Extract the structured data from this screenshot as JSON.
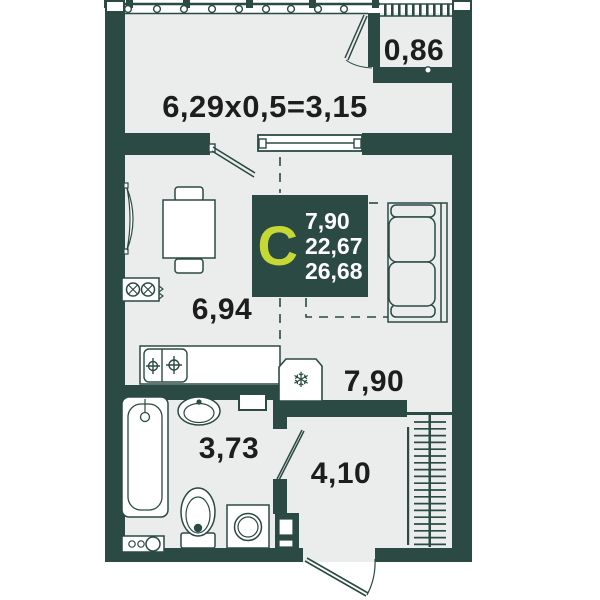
{
  "plan": {
    "labels": {
      "balcony_calc": "6,29х0,5=3,15",
      "balcony_small": "0,86",
      "kitchen_living": "6,94",
      "room": "7,90",
      "bathroom": "3,73",
      "hallway": "4,10"
    },
    "badge": {
      "type_letter": "С",
      "room_area": "7,90",
      "living_area": "22,67",
      "total_area": "26,68"
    },
    "icons": {
      "fridge_snowflake": "❄"
    },
    "colors": {
      "wall": "#2b4a43",
      "floor": "#ebedec",
      "badge_bg": "#2b4a43",
      "accent_letter": "#c6d835",
      "label_text": "#1d1d1d"
    }
  }
}
